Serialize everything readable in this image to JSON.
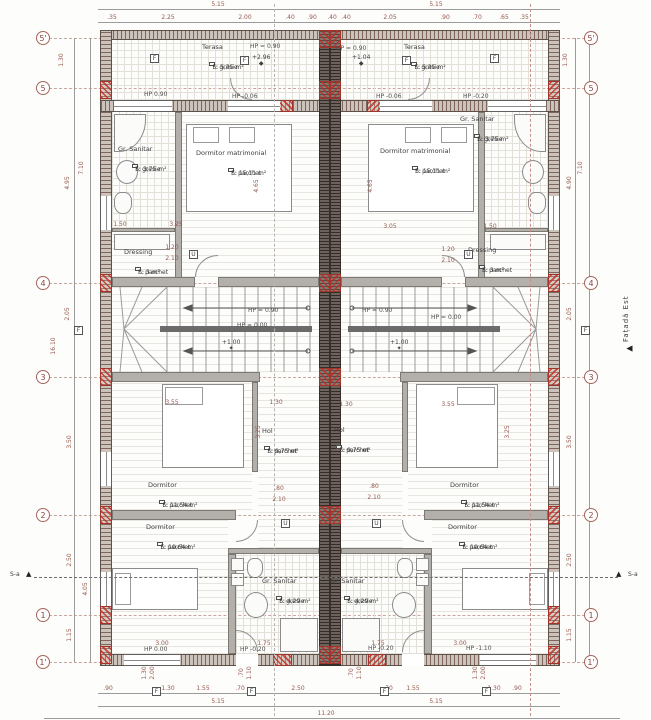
{
  "markers": {
    "facade": "Fațadă Est",
    "section": "S-a"
  },
  "grid": {
    "left_x": 36,
    "right_x": 584,
    "rows": [
      {
        "label": "5'",
        "y": 38
      },
      {
        "label": "5",
        "y": 88
      },
      {
        "label": "4",
        "y": 283
      },
      {
        "label": "3",
        "y": 377
      },
      {
        "label": "2",
        "y": 515
      },
      {
        "label": "1",
        "y": 615
      },
      {
        "label": "1'",
        "y": 662
      }
    ]
  },
  "dims": [
    {
      "t": "5.15",
      "x": 218,
      "y": 2
    },
    {
      "t": "5.15",
      "x": 436,
      "y": 2
    },
    {
      "t": ".35",
      "x": 112,
      "y": 15
    },
    {
      "t": "2.25",
      "x": 168,
      "y": 15
    },
    {
      "t": "2.00",
      "x": 245,
      "y": 15
    },
    {
      "t": ".40",
      "x": 290,
      "y": 15
    },
    {
      "t": ".90",
      "x": 312,
      "y": 15
    },
    {
      "t": ".40",
      "x": 332,
      "y": 15
    },
    {
      "t": ".40",
      "x": 346,
      "y": 15
    },
    {
      "t": "2.05",
      "x": 390,
      "y": 15
    },
    {
      "t": ".90",
      "x": 445,
      "y": 15
    },
    {
      "t": ".70",
      "x": 477,
      "y": 15
    },
    {
      "t": ".65",
      "x": 504,
      "y": 15
    },
    {
      "t": ".35",
      "x": 524,
      "y": 15
    },
    {
      "t": ".90",
      "x": 108,
      "y": 686
    },
    {
      "t": "1.30",
      "x": 168,
      "y": 686
    },
    {
      "t": "1.55",
      "x": 203,
      "y": 686
    },
    {
      "t": ".70",
      "x": 240,
      "y": 686
    },
    {
      "t": "2.50",
      "x": 298,
      "y": 686
    },
    {
      "t": ".70",
      "x": 388,
      "y": 686
    },
    {
      "t": "1.55",
      "x": 413,
      "y": 686
    },
    {
      "t": "1.30",
      "x": 494,
      "y": 686
    },
    {
      "t": ".90",
      "x": 517,
      "y": 686
    },
    {
      "t": "5.15",
      "x": 218,
      "y": 699
    },
    {
      "t": "5.15",
      "x": 436,
      "y": 699
    },
    {
      "t": "11.20",
      "x": 326,
      "y": 711
    },
    {
      "t": "1.30",
      "x": 62,
      "y": 60,
      "r": 1
    },
    {
      "t": "4.95",
      "x": 68,
      "y": 183,
      "r": 1
    },
    {
      "t": "7.10",
      "x": 82,
      "y": 168,
      "r": 1
    },
    {
      "t": "2.05",
      "x": 68,
      "y": 314,
      "r": 1
    },
    {
      "t": "3.50",
      "x": 70,
      "y": 442,
      "r": 1
    },
    {
      "t": "2.50",
      "x": 70,
      "y": 560,
      "r": 1
    },
    {
      "t": "4.05",
      "x": 86,
      "y": 589,
      "r": 1
    },
    {
      "t": "1.15",
      "x": 70,
      "y": 635,
      "r": 1
    },
    {
      "t": "16.10",
      "x": 54,
      "y": 346,
      "r": 1
    },
    {
      "t": "1.30",
      "x": 566,
      "y": 60,
      "r": 1
    },
    {
      "t": "4.90",
      "x": 570,
      "y": 183,
      "r": 1
    },
    {
      "t": "7.10",
      "x": 581,
      "y": 168,
      "r": 1
    },
    {
      "t": "2.05",
      "x": 570,
      "y": 314,
      "r": 1
    },
    {
      "t": "3.50",
      "x": 570,
      "y": 442,
      "r": 1
    },
    {
      "t": "2.50",
      "x": 570,
      "y": 560,
      "r": 1
    },
    {
      "t": "1.15",
      "x": 570,
      "y": 635,
      "r": 1
    },
    {
      "t": "1.50",
      "x": 120,
      "y": 222
    },
    {
      "t": "3.25",
      "x": 176,
      "y": 222
    },
    {
      "t": "4.65",
      "x": 257,
      "y": 186,
      "r": 1
    },
    {
      "t": "1.50",
      "x": 490,
      "y": 224
    },
    {
      "t": "3.05",
      "x": 390,
      "y": 224
    },
    {
      "t": "4.65",
      "x": 371,
      "y": 186,
      "r": 1
    },
    {
      "t": "3.55",
      "x": 172,
      "y": 400
    },
    {
      "t": "1.30",
      "x": 276,
      "y": 400
    },
    {
      "t": "1.30",
      "x": 346,
      "y": 402
    },
    {
      "t": "3.55",
      "x": 448,
      "y": 402
    },
    {
      "t": "3.25",
      "x": 259,
      "y": 432,
      "r": 1
    },
    {
      "t": "3.25",
      "x": 508,
      "y": 432,
      "r": 1
    },
    {
      "t": ".80",
      "x": 279,
      "y": 486
    },
    {
      "t": "2.10",
      "x": 279,
      "y": 497
    },
    {
      "t": ".80",
      "x": 374,
      "y": 484
    },
    {
      "t": "2.10",
      "x": 374,
      "y": 495
    },
    {
      "t": "1.20",
      "x": 172,
      "y": 245
    },
    {
      "t": "2.10",
      "x": 172,
      "y": 256
    },
    {
      "t": "1.20",
      "x": 448,
      "y": 247
    },
    {
      "t": "2.10",
      "x": 448,
      "y": 258
    },
    {
      "t": "3.00",
      "x": 162,
      "y": 641
    },
    {
      "t": "1.75",
      "x": 264,
      "y": 641
    },
    {
      "t": "1.75",
      "x": 378,
      "y": 641
    },
    {
      "t": "3.00",
      "x": 460,
      "y": 641
    },
    {
      "t": "1.30",
      "x": 145,
      "y": 673,
      "r": 1
    },
    {
      "t": "2.00",
      "x": 153,
      "y": 673,
      "r": 1
    },
    {
      "t": ".70",
      "x": 242,
      "y": 673,
      "r": 1
    },
    {
      "t": "1.10",
      "x": 250,
      "y": 673,
      "r": 1
    },
    {
      "t": ".70",
      "x": 352,
      "y": 673,
      "r": 1
    },
    {
      "t": "1.10",
      "x": 360,
      "y": 673,
      "r": 1
    },
    {
      "t": "1.30",
      "x": 476,
      "y": 673,
      "r": 1
    },
    {
      "t": "2.00",
      "x": 484,
      "y": 673,
      "r": 1
    }
  ],
  "rooms": [
    {
      "name": "Terasa",
      "f": "F:  gresie",
      "s": "S: 5,35 m²",
      "x": 202,
      "y": 44
    },
    {
      "name": "Gr. Sanitar",
      "f": "F:  gresie",
      "s": "S: 3,75 m²",
      "x": 118,
      "y": 146
    },
    {
      "name": "Dormitor matrimonial",
      "f": "F:  parchet",
      "s": "S: 15,11 m²",
      "x": 196,
      "y": 150
    },
    {
      "name": "Dressing",
      "f": "F:  parchet",
      "s": "S: 3 m²",
      "x": 124,
      "y": 249
    },
    {
      "name": "Hol",
      "f": "F:  parchet",
      "s": "S: 9,75 m²",
      "x": 262,
      "y": 428
    },
    {
      "name": "Dormitor",
      "f": "F:  parchet",
      "s": "S: 11,54 m²",
      "x": 148,
      "y": 482
    },
    {
      "name": "Dormitor",
      "f": "F:  parchet",
      "s": "S: 10,64 m²",
      "x": 146,
      "y": 524
    },
    {
      "name": "Gr. Sanitar",
      "f": "F:  gresie",
      "s": "S: 4,29 m²",
      "x": 262,
      "y": 578
    },
    {
      "name": "Terasa",
      "f": "F:  gresie",
      "s": "S: 5,35 m²",
      "x": 404,
      "y": 44
    },
    {
      "name": "Gr. Sanitar",
      "f": "F:  gresie",
      "s": "S: 3,75 m²",
      "x": 460,
      "y": 116
    },
    {
      "name": "Dormitor matrimonial",
      "f": "F:  parchet",
      "s": "S: 15,11 m²",
      "x": 380,
      "y": 148
    },
    {
      "name": "Dressing",
      "f": "F:  parchet",
      "s": "S: 3 m²",
      "x": 468,
      "y": 247
    },
    {
      "name": "Hol",
      "f": "F:  parchet",
      "s": "S: 9,75 m²",
      "x": 334,
      "y": 427
    },
    {
      "name": "Dormitor",
      "f": "F:  parchet",
      "s": "S: 11,54 m²",
      "x": 450,
      "y": 482
    },
    {
      "name": "Dormitor",
      "f": "F:  parchet",
      "s": "S: 10,64 m²",
      "x": 448,
      "y": 524
    },
    {
      "name": "Gr. Sanitar",
      "f": "F:  gresie",
      "s": "S: 4,29 m²",
      "x": 330,
      "y": 578
    }
  ],
  "hp_labels": [
    {
      "t": "HP 0.90",
      "x": 144,
      "y": 92
    },
    {
      "t": "HP -0.06",
      "x": 232,
      "y": 94
    },
    {
      "t": "HP -0.06",
      "x": 376,
      "y": 94
    },
    {
      "t": "HP -0.20",
      "x": 463,
      "y": 94
    },
    {
      "t": "HP = 0.90",
      "x": 250,
      "y": 44
    },
    {
      "t": "HP = 0.90",
      "x": 336,
      "y": 46
    },
    {
      "t": "HP = 0.90",
      "x": 248,
      "y": 308
    },
    {
      "t": "HP = 0.00",
      "x": 237,
      "y": 323
    },
    {
      "t": "HP = 0.90",
      "x": 362,
      "y": 308
    },
    {
      "t": "HP = 0.00",
      "x": 431,
      "y": 315
    },
    {
      "t": "HP 0.00",
      "x": 144,
      "y": 647
    },
    {
      "t": "HP -0.20",
      "x": 240,
      "y": 647
    },
    {
      "t": "HP -0.20",
      "x": 368,
      "y": 646
    },
    {
      "t": "HP -1.10",
      "x": 466,
      "y": 646
    }
  ],
  "levels": [
    {
      "t": "+2.96",
      "x": 252,
      "y": 55,
      "sym": "◆"
    },
    {
      "t": "+1.04",
      "x": 352,
      "y": 55,
      "sym": "◆"
    },
    {
      "t": "+1.00",
      "x": 222,
      "y": 340,
      "sym": "✦"
    },
    {
      "t": "+1.00",
      "x": 390,
      "y": 340,
      "sym": "✦"
    }
  ],
  "window_tags": {
    "label": "F",
    "pos": [
      [
        150,
        54
      ],
      [
        240,
        56
      ],
      [
        402,
        56
      ],
      [
        490,
        54
      ],
      [
        152,
        687
      ],
      [
        247,
        687
      ],
      [
        380,
        687
      ],
      [
        482,
        687
      ],
      [
        74,
        326
      ],
      [
        581,
        326
      ]
    ]
  },
  "door_tags": {
    "label": "U",
    "pos": [
      [
        281,
        519
      ],
      [
        372,
        519
      ],
      [
        189,
        250
      ],
      [
        464,
        250
      ]
    ]
  }
}
